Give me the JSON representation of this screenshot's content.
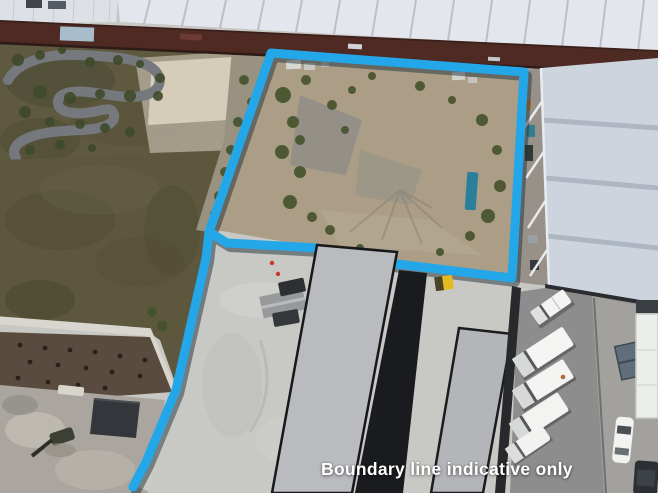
{
  "caption": {
    "text": "Boundary line indicative only",
    "color": "#ffffff"
  },
  "boundary": {
    "color": "#24a7e8",
    "shadow_color": "#22313a"
  },
  "scene": {
    "type": "aerial-drone-photo",
    "features": [
      "north-industrial-roof",
      "north-dark-wall",
      "karting-track",
      "concrete-pad",
      "grass-field",
      "walkway",
      "tilled-soil",
      "gravel-yard",
      "storage-shed",
      "excavator",
      "vacant-dirt-lot",
      "east-warehouse-roof",
      "central-building-roof",
      "dark-roof-strip",
      "second-building-roof",
      "concrete-apron",
      "parking-lot",
      "white-trucks",
      "ute",
      "van",
      "white-car",
      "dumpster",
      "truck-trailer",
      "dark-car",
      "yellow-forklift",
      "canopy-shelter",
      "boundary-line"
    ]
  }
}
